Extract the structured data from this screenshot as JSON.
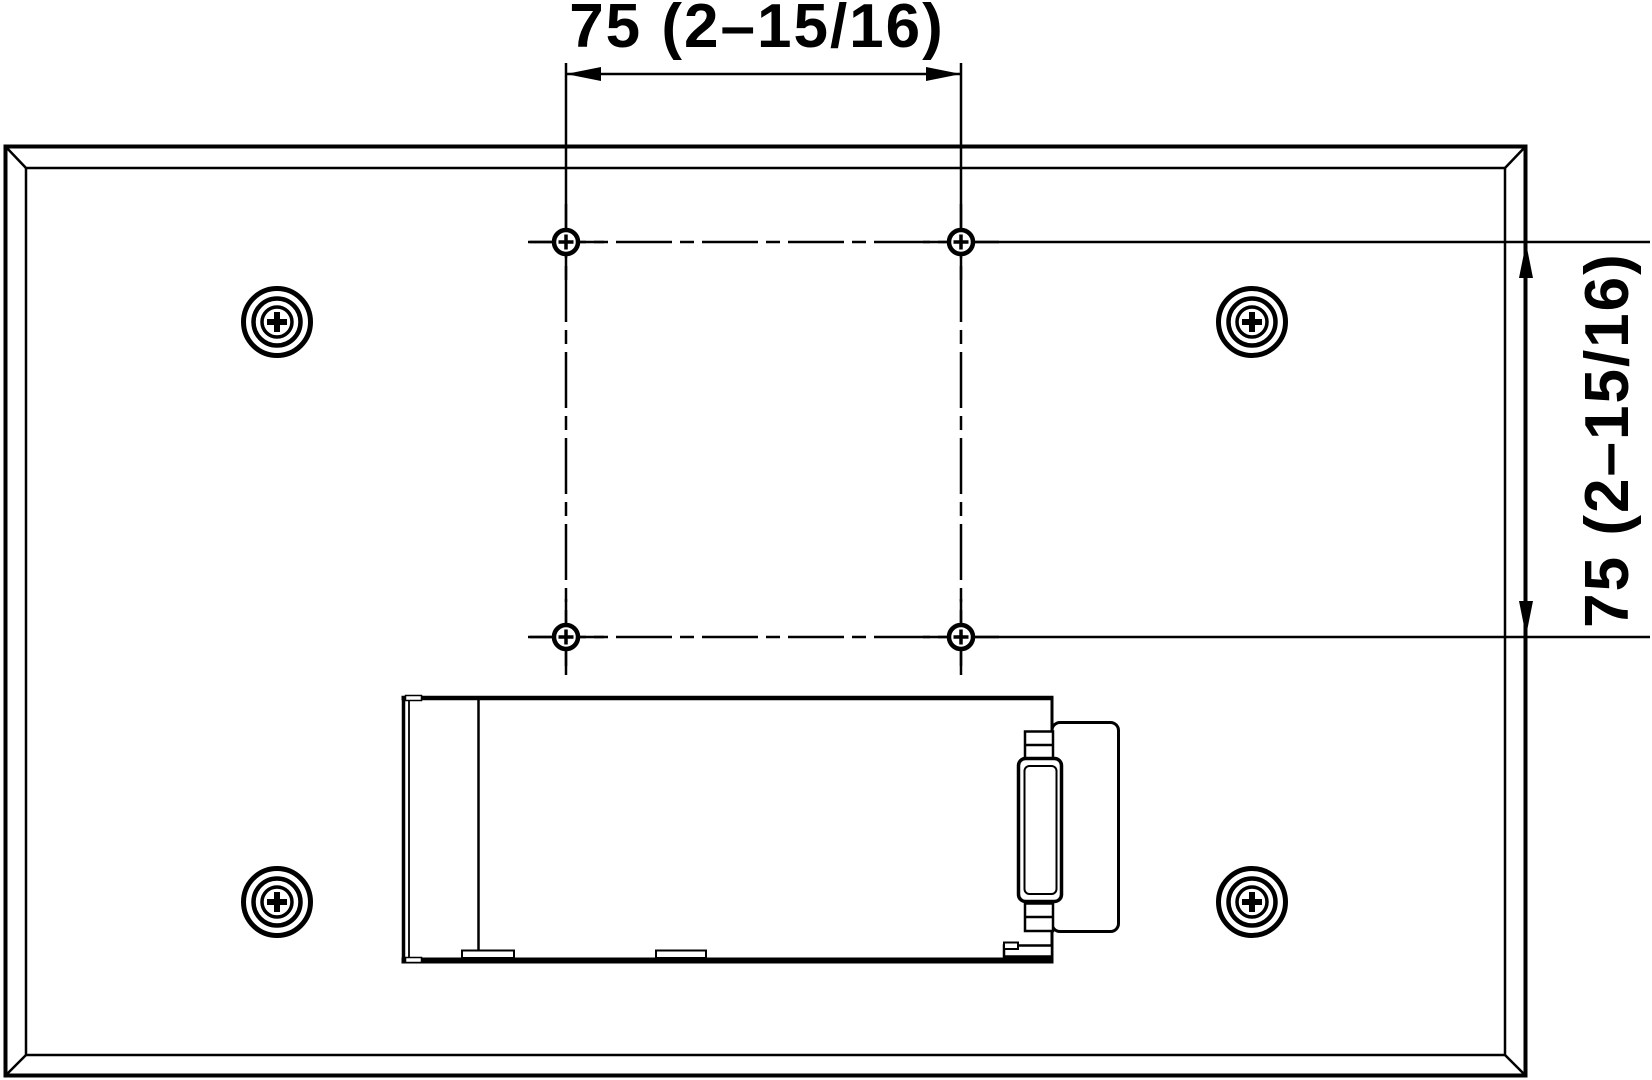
{
  "drawing": {
    "background_color": "#ffffff",
    "line_color": "#000000",
    "dimensions": {
      "horizontal": {
        "label": "75 (2–15/16)"
      },
      "vertical": {
        "label": "75 (2–15/16)"
      }
    },
    "features": {
      "corner_screws": 4,
      "vesa_mounting_holes": 4
    }
  }
}
